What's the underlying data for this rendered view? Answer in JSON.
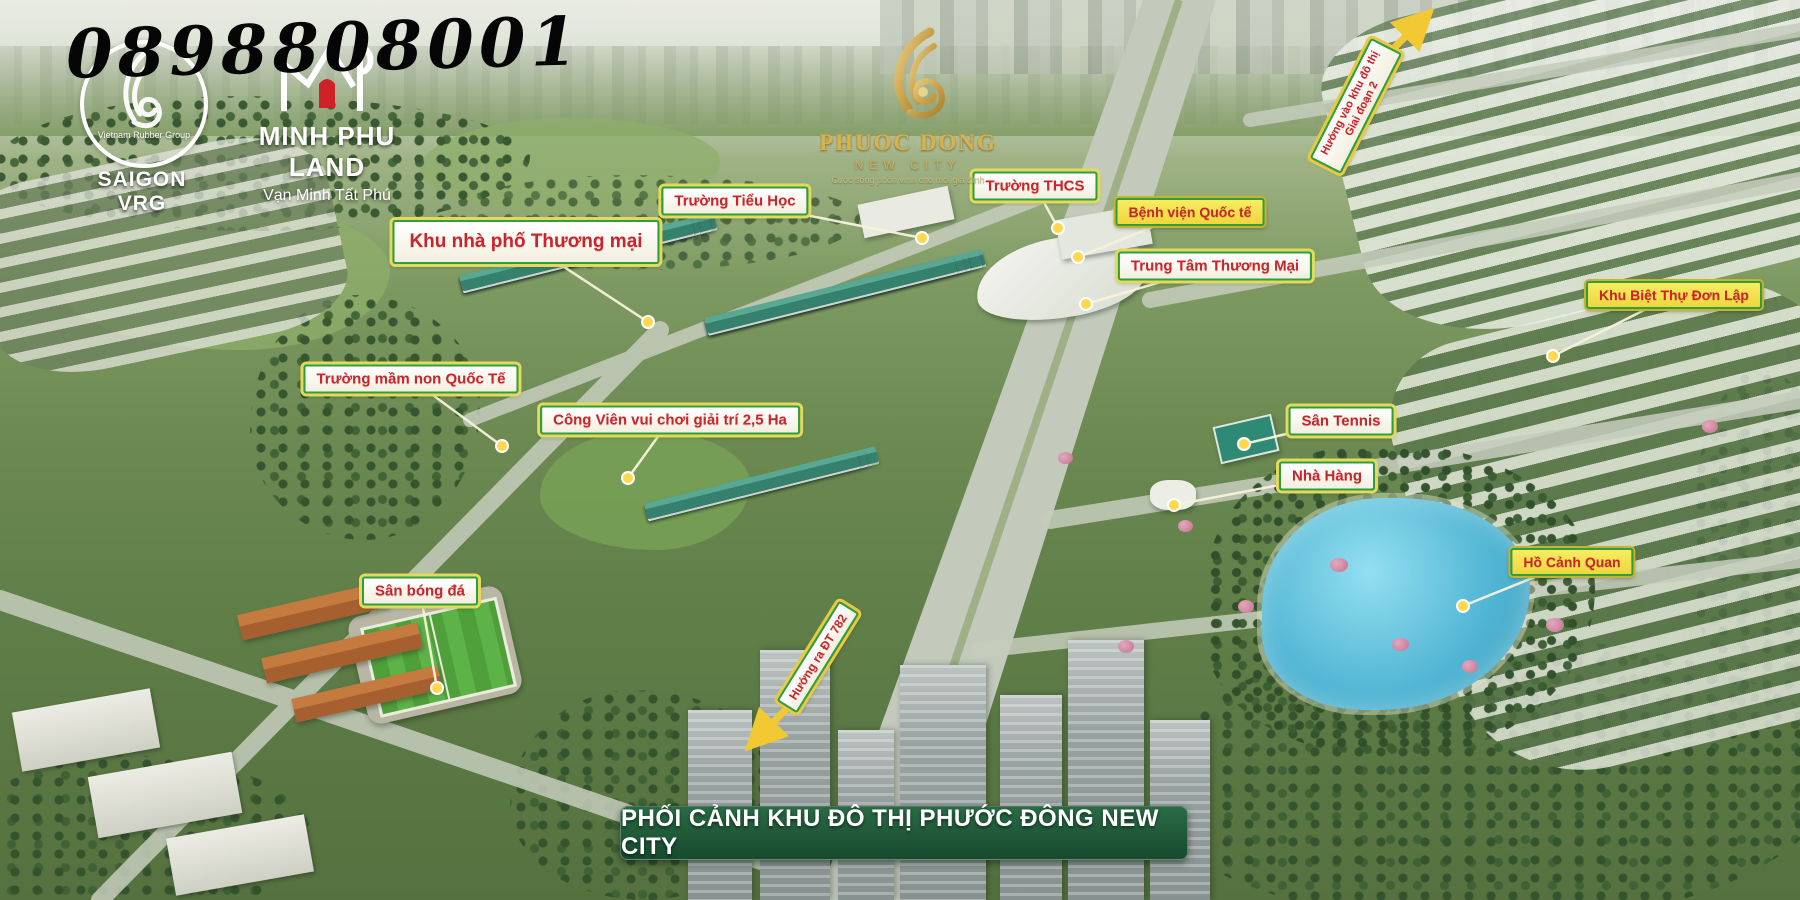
{
  "phone": "0898808001",
  "banner": "PHỐI CẢNH KHU ĐÔ THỊ PHƯỚC ĐÔNG NEW CITY",
  "logos": {
    "saigon_vrg": {
      "ring_text": "Vietnam Rubber Group",
      "name": "SAIGON VRG"
    },
    "minh_phu_land": {
      "name": "MINH PHU LAND",
      "tagline": "Vạn Minh Tất Phú"
    },
    "phuoc_dong": {
      "name": "PHUOC DONG",
      "subtitle": "NEW CITY",
      "tagline": "Cuộc sống phồn vinh cho mọi gia đình"
    }
  },
  "colors": {
    "label_text": "#c9252b",
    "label_border": "#2e9e3f",
    "label_outer": "#e3d95c",
    "tag_bg": "#f2df49",
    "banner_bg": "#1b5635",
    "leader": "#f7f3da",
    "marker": "#ffd84d",
    "arrow": "#f2c933",
    "lake": "#54bcd9"
  },
  "labels": [
    {
      "id": "khu-nha-pho-thuong-mai",
      "text": "Khu nhà phố Thương mại",
      "x": 526,
      "y": 242,
      "tx": 648,
      "ty": 322
    },
    {
      "id": "truong-tieu-hoc",
      "text": "Trường Tiểu Học",
      "x": 735,
      "y": 201,
      "tx": 922,
      "ty": 238
    },
    {
      "id": "truong-thcs",
      "text": "Trường THCS",
      "x": 1035,
      "y": 186,
      "tx": 1058,
      "ty": 228
    },
    {
      "id": "benh-vien-quoc-te",
      "text": "Bệnh viện Quốc tế",
      "x": 1190,
      "y": 212,
      "tx": 1078,
      "ty": 257
    },
    {
      "id": "trung-tam-thuong-mai",
      "text": "Trung Tâm Thương Mại",
      "x": 1215,
      "y": 266,
      "tx": 1086,
      "ty": 304
    },
    {
      "id": "khu-biet-thu-don-lap",
      "text": "Khu Biệt Thự Đơn Lập",
      "x": 1674,
      "y": 295,
      "tx": 1553,
      "ty": 356
    },
    {
      "id": "truong-mam-non-quoc-te",
      "text": "Trường mầm non Quốc Tế",
      "x": 411,
      "y": 379,
      "tx": 502,
      "ty": 446
    },
    {
      "id": "cong-vien-vui-choi",
      "text": "Công Viên vui chơi giải trí 2,5 Ha",
      "x": 670,
      "y": 420,
      "tx": 628,
      "ty": 478
    },
    {
      "id": "san-tennis",
      "text": "Sân Tennis",
      "x": 1341,
      "y": 421,
      "tx": 1244,
      "ty": 444
    },
    {
      "id": "nha-hang",
      "text": "Nhà Hàng",
      "x": 1327,
      "y": 476,
      "tx": 1174,
      "ty": 505
    },
    {
      "id": "ho-canh-quan",
      "text": "Hồ Cảnh Quan",
      "x": 1572,
      "y": 562,
      "tx": 1463,
      "ty": 606
    },
    {
      "id": "san-bong-da",
      "text": "Sân bóng đá",
      "x": 420,
      "y": 591,
      "tx": 437,
      "ty": 688
    },
    {
      "id": "huong-ra-dt-782",
      "text": "Hướng ra ĐT 782",
      "x": 818,
      "y": 657,
      "rot": -58
    },
    {
      "id": "huong-vao-khu-do-thi",
      "text": "Hướng vào khu đô thị\nGiai đoạn 2",
      "x": 1356,
      "y": 106,
      "rot": -63
    }
  ],
  "arrows": [
    {
      "x1": 803,
      "y1": 692,
      "x2": 752,
      "y2": 744
    },
    {
      "x1": 1380,
      "y1": 62,
      "x2": 1427,
      "y2": 15
    }
  ]
}
